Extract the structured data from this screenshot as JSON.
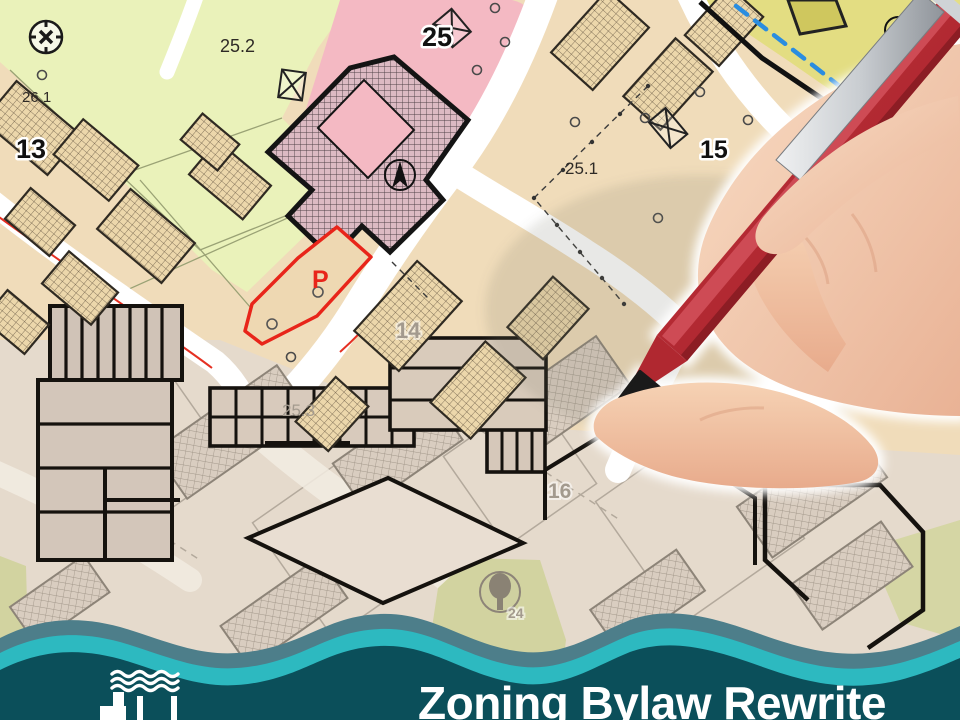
{
  "banner": {
    "title": "Zoning Bylaw Rewrite",
    "colors": {
      "base": "#0b4f5a",
      "wave_mid": "#4d7e8a",
      "wave_accent": "#2db9c0",
      "text": "#ffffff"
    },
    "logo": "waterfront-dock-logo"
  },
  "map": {
    "type": "zoning-cadastral-map",
    "parcel_labels": [
      {
        "id": "25_2",
        "text": "25.2"
      },
      {
        "id": "25",
        "text": "25"
      },
      {
        "id": "26_1",
        "text": "26.1"
      },
      {
        "id": "13",
        "text": "13"
      },
      {
        "id": "25_1",
        "text": "25.1"
      },
      {
        "id": "15",
        "text": "15"
      },
      {
        "id": "P",
        "text": "P"
      },
      {
        "id": "14",
        "text": "14"
      },
      {
        "id": "25_3",
        "text": "25.3"
      },
      {
        "id": "16",
        "text": "16"
      },
      {
        "id": "24",
        "text": "24"
      }
    ],
    "zone_colors": {
      "green": "#eaf2ba",
      "pink": "#f4b9c3",
      "yellow": "#e3dd82",
      "tan": "#f0dcba",
      "faded_plan": "#e5dacc",
      "street": "#ffffff",
      "highlight_parcel_outline": "#e8251a",
      "survey_line_blue": "#2a8de0"
    },
    "symbols": [
      "survey-marker-icon",
      "north-compass-icon",
      "crossed-box-icon",
      "tree-icon"
    ]
  },
  "overlay": {
    "description": "hand-holding-red-pen",
    "pen_color": "#b02830"
  }
}
